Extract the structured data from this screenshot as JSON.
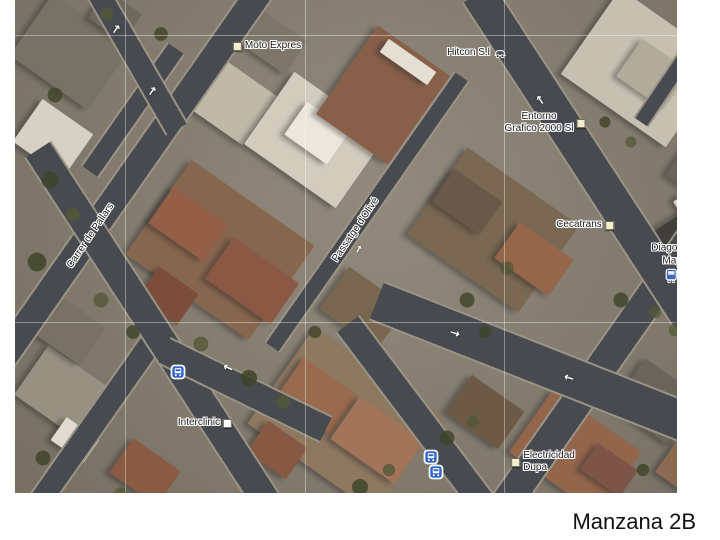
{
  "caption": "Manzana 2B",
  "map": {
    "street_labels": [
      {
        "text": "Carrer de Pallars"
      },
      {
        "text": "Passatge d'Olivé"
      }
    ],
    "places": {
      "moto_expres": {
        "label": "Moto Expres"
      },
      "hitcon": {
        "label": "Hitcon S.l"
      },
      "entorno": {
        "line1": "Entorno",
        "line2": "Grafico 2000 Sl"
      },
      "cecatrans": {
        "label": "Cecatrans"
      },
      "diagonal_mar": {
        "line1": "Diagonal",
        "line2": "Mar"
      },
      "interclinic": {
        "label": "Interclinic"
      },
      "electricidad": {
        "line1": "Electricidad",
        "line2": "Dupa"
      }
    },
    "icons": {
      "one_way_arrow": "→",
      "bus_stop": "bus-stop-icon",
      "tram_station": "tram-station-icon",
      "car": "car-icon",
      "poi_marker": "poi-square-marker"
    },
    "colors": {
      "street": "#474a4f",
      "transit_blue": "#2e62c9",
      "label_text": "#1b1b1b",
      "label_halo": "#ffffff"
    }
  }
}
